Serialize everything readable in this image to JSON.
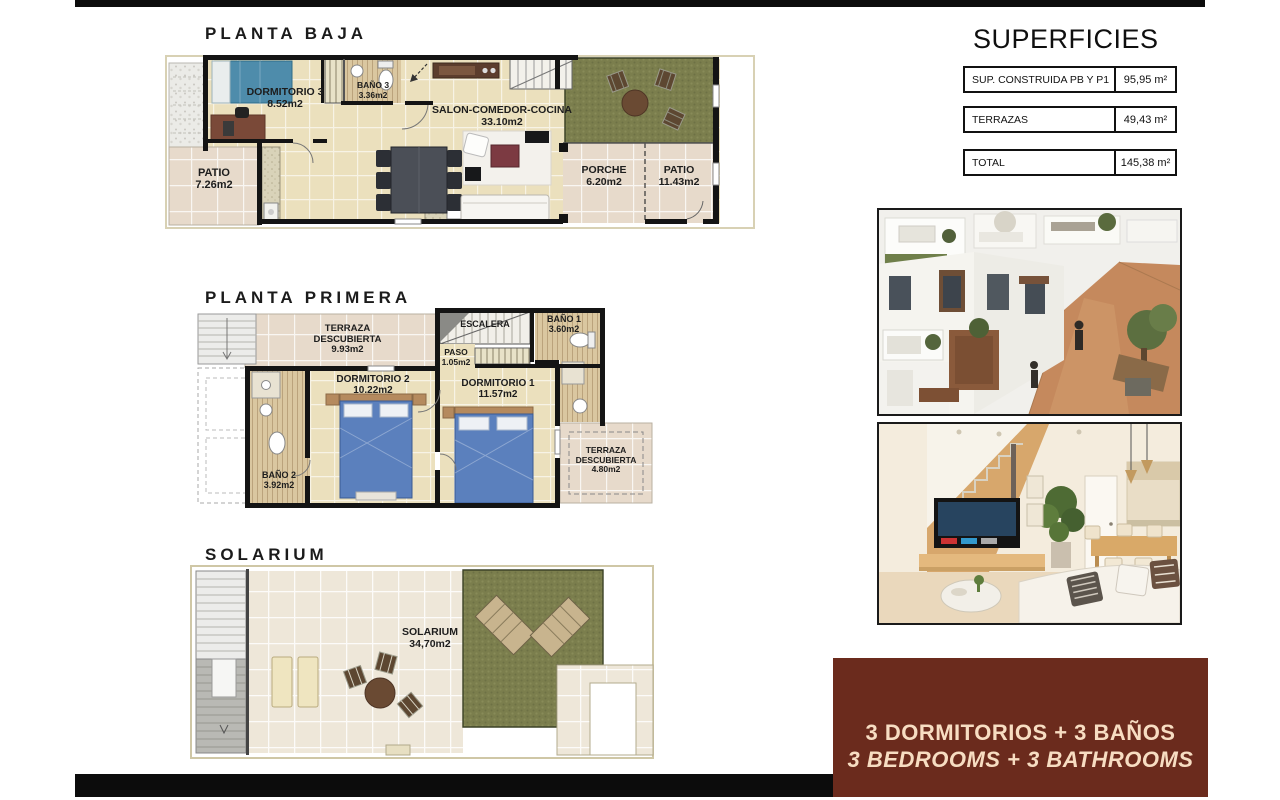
{
  "titles": {
    "planta_baja": "PLANTA BAJA",
    "planta_primera": "PLANTA PRIMERA",
    "solarium": "SOLARIUM"
  },
  "superficies": {
    "title": "SUPERFICIES",
    "rows": [
      {
        "label": "SUP. CONSTRUIDA PB Y P1",
        "value": "95,95 m²"
      },
      {
        "label": "TERRAZAS",
        "value": "49,43 m²"
      },
      {
        "label": "TOTAL",
        "value": "145,38 m²"
      }
    ]
  },
  "floors": {
    "planta_baja": {
      "rooms": {
        "dormitorio3": {
          "name": "DORMITORIO 3",
          "area": "8.52m2"
        },
        "bano3": {
          "name": "BAÑO 3",
          "area": "3.36m2"
        },
        "salon": {
          "name": "SALON-COMEDOR-COCINA",
          "area": "33.10m2"
        },
        "patio_izq": {
          "name": "PATIO",
          "area": "7.26m2"
        },
        "porche": {
          "name": "PORCHE",
          "area": "6.20m2"
        },
        "patio_der": {
          "name": "PATIO",
          "area": "11.43m2"
        }
      }
    },
    "planta_primera": {
      "rooms": {
        "terraza1": {
          "name": "TERRAZA DESCUBIERTA",
          "area": "9.93m2"
        },
        "escalera": {
          "name": "ESCALERA",
          "area": ""
        },
        "paso": {
          "name": "PASO",
          "area": "1.05m2"
        },
        "bano1": {
          "name": "BAÑO 1",
          "area": "3.60m2"
        },
        "dormitorio2": {
          "name": "DORMITORIO 2",
          "area": "10.22m2"
        },
        "bano2": {
          "name": "BAÑO 2",
          "area": "3.92m2"
        },
        "dormitorio1": {
          "name": "DORMITORIO 1",
          "area": "11.57m2"
        },
        "terraza2": {
          "name": "TERRAZA DESCUBIERTA",
          "area": "4.80m2"
        }
      }
    },
    "solarium": {
      "rooms": {
        "solarium": {
          "name": "SOLARIUM",
          "area": "34,70m2"
        }
      }
    }
  },
  "photos": [
    {
      "name": "exterior-render"
    },
    {
      "name": "interior-render"
    }
  ],
  "banner": {
    "line1": "3 DORMITORIOS + 3 BAÑOS",
    "line2": "3 BEDROOMS + 3 BATHROOMS"
  },
  "colors": {
    "banner_bg": "#6b2b1d",
    "banner_text": "#f7ddc2",
    "wall": "#141414",
    "floor_tile": "#ebe0bd",
    "terrace_tile": "#e7dacb",
    "bath_wood": "#dac7a0",
    "grass": "#7b7e4d",
    "bed_blue_pb": "#4e8cab",
    "bed_blue_p1": "#5b80bd"
  }
}
